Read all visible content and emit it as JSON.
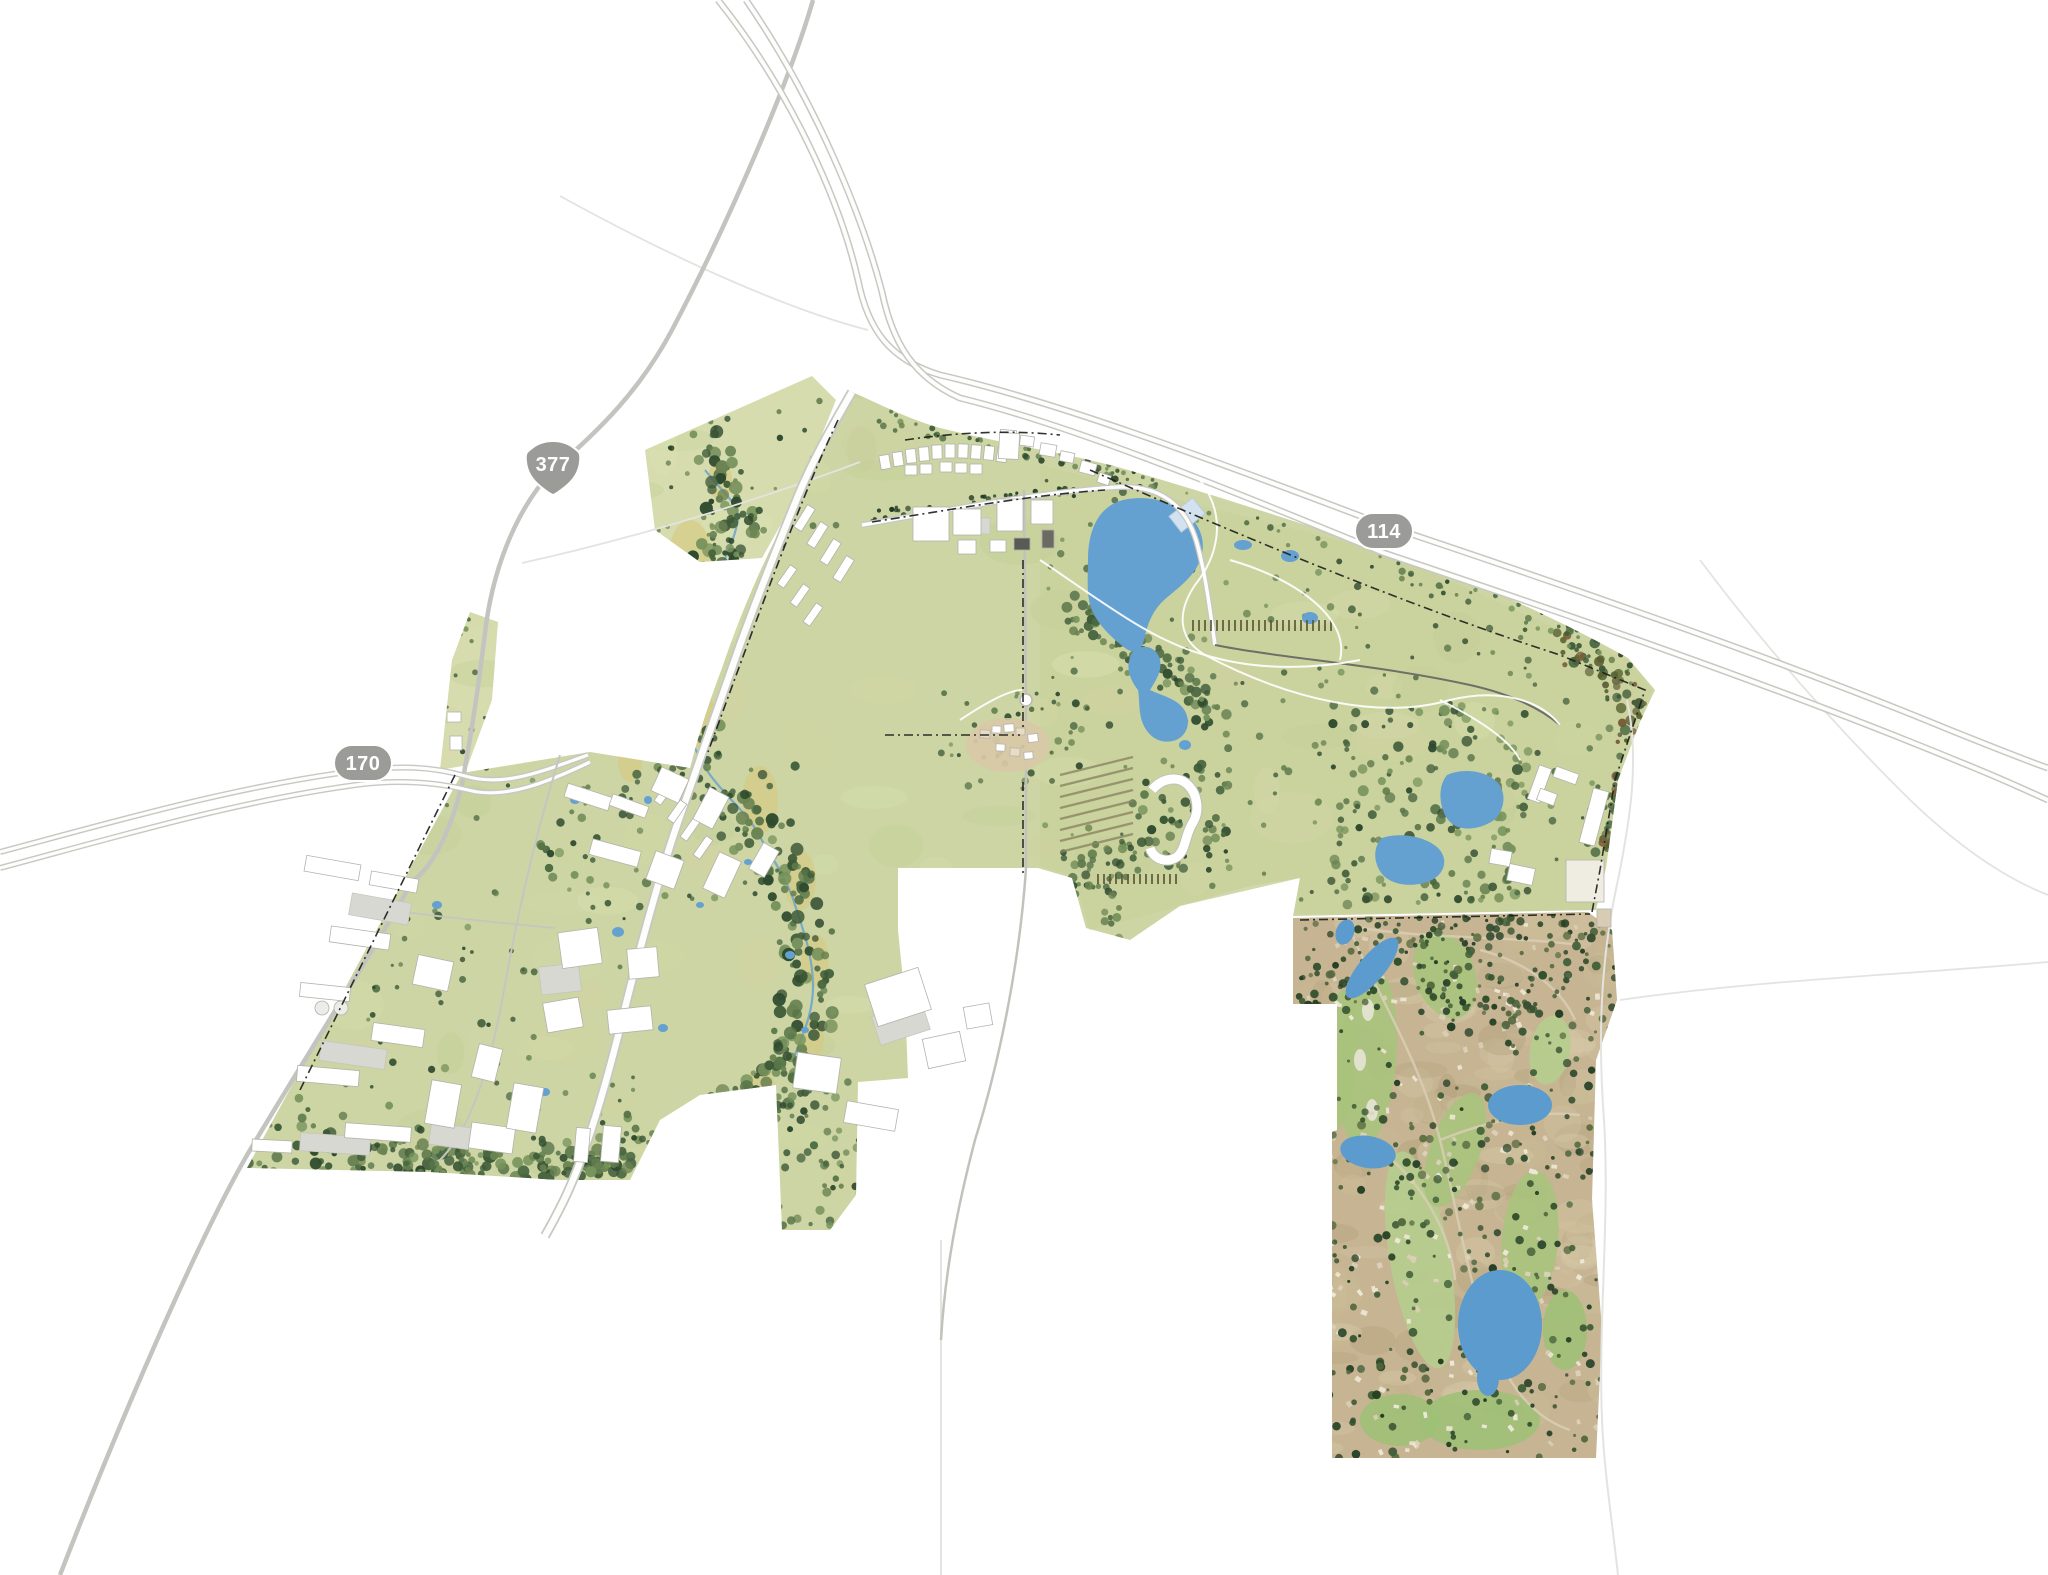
{
  "map": {
    "name": "master-plan-site-map",
    "background_color": "#ffffff",
    "shields": [
      {
        "id": "us-377",
        "type": "us-route-shield",
        "label": "377",
        "x": 553,
        "y": 464
      },
      {
        "id": "sh-170",
        "type": "state-highway-pill",
        "label": "170",
        "x": 363,
        "y": 763
      },
      {
        "id": "sh-114",
        "type": "state-highway-pill",
        "label": "114",
        "x": 1384,
        "y": 531
      }
    ],
    "colors": {
      "shield_gray": "#9b9b98",
      "road_casing": "#c7c7c3",
      "road_core": "#fdfdfc",
      "minor_road": "#c3c3c0",
      "faint_road": "#e3e3e0",
      "plan_green": "#ccd5a3",
      "pasture_green": "#c9d19d",
      "field_light": "#d6dcae",
      "tree_dark": "#3d5a38",
      "meadow_gold": "#d6cb85",
      "water_blue": "#64a0d0",
      "dam_light": "#d3e2f0",
      "building_white": "#ffffff",
      "building_stroke": "#b3b3ac",
      "village_tan": "#d9c9a6",
      "aerial_tan": "#c6b492",
      "fairway_green": "#a8c37d",
      "boundary_dash": "#1c1c1c"
    },
    "regions": [
      "highway-114-corridor",
      "highway-170-corridor",
      "highway-377-corridor",
      "town-center",
      "big-lake",
      "creek-corridor",
      "office-park-west",
      "east-pasture",
      "corporate-campus-east",
      "village-center",
      "resort",
      "golf-course-community-aerial"
    ]
  }
}
